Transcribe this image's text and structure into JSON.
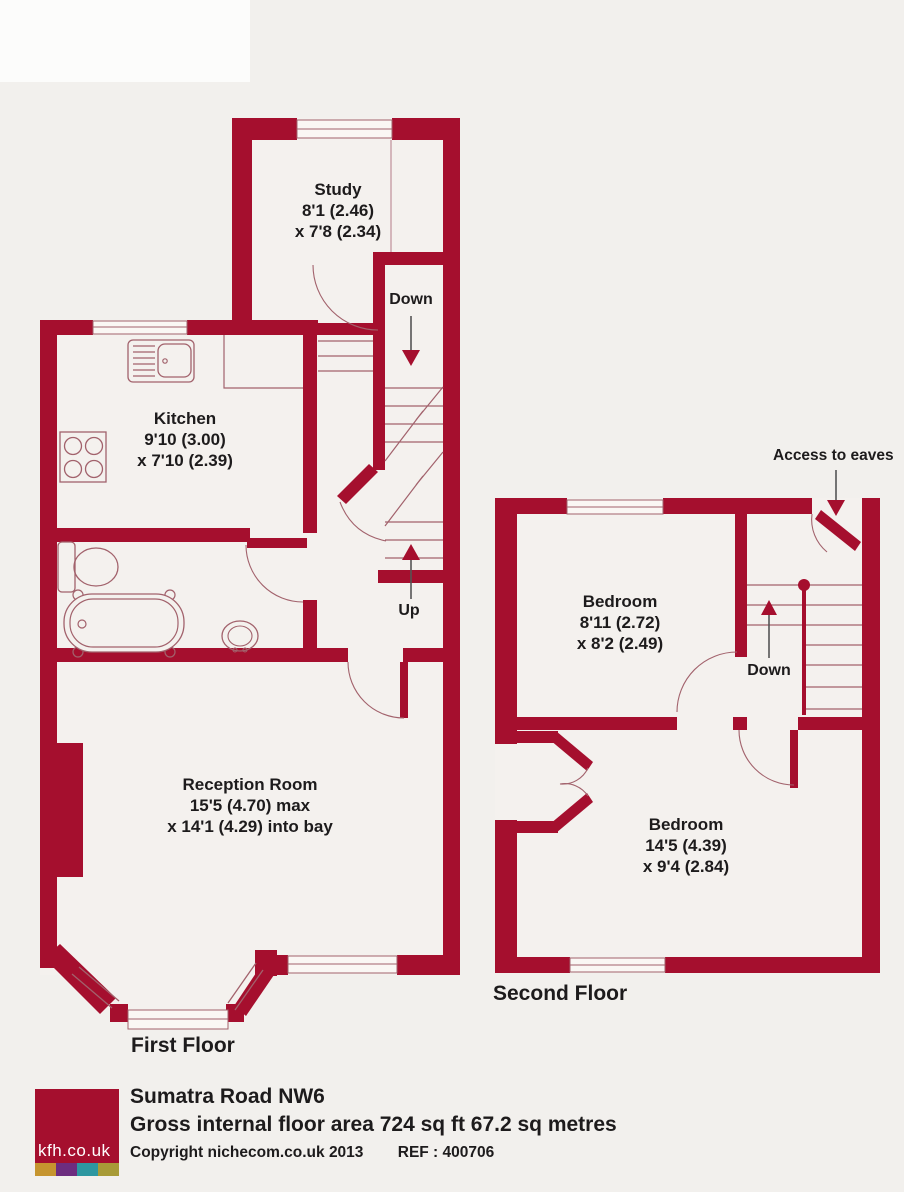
{
  "colors": {
    "wall": "#a50f2e",
    "room_fill": "#f4f1ee",
    "page_background": "#f2f0ed",
    "thin_line": "#a2626c",
    "text": "#1d1b1c"
  },
  "first_floor": {
    "label": "First Floor",
    "rooms": [
      {
        "name": "Study",
        "dim_line1": "8'1 (2.46)",
        "dim_line2": "x 7'8 (2.34)"
      },
      {
        "name": "Kitchen",
        "dim_line1": "9'10 (3.00)",
        "dim_line2": "x 7'10 (2.39)"
      },
      {
        "name": "Reception Room",
        "dim_line1": "15'5 (4.70) max",
        "dim_line2": "x 14'1 (4.29) into bay"
      }
    ],
    "stairs": {
      "down_label": "Down",
      "up_label": "Up"
    }
  },
  "second_floor": {
    "label": "Second Floor",
    "annotation": "Access to eaves",
    "rooms": [
      {
        "name": "Bedroom",
        "dim_line1": "8'11 (2.72)",
        "dim_line2": "x 8'2 (2.49)"
      },
      {
        "name": "Bedroom",
        "dim_line1": "14'5 (4.39)",
        "dim_line2": "x 9'4 (2.84)"
      }
    ],
    "stairs": {
      "down_label": "Down"
    }
  },
  "footer": {
    "logo_text": "kfh.co.uk",
    "title": "Sumatra Road NW6",
    "area_line": "Gross internal floor area 724 sq ft 67.2 sq metres",
    "copyright": "Copyright nichecom.co.uk 2013",
    "ref": "REF : 400706",
    "logo_colors": [
      "#c6952f",
      "#6d2d7f",
      "#2d97a0",
      "#a89b37"
    ]
  }
}
